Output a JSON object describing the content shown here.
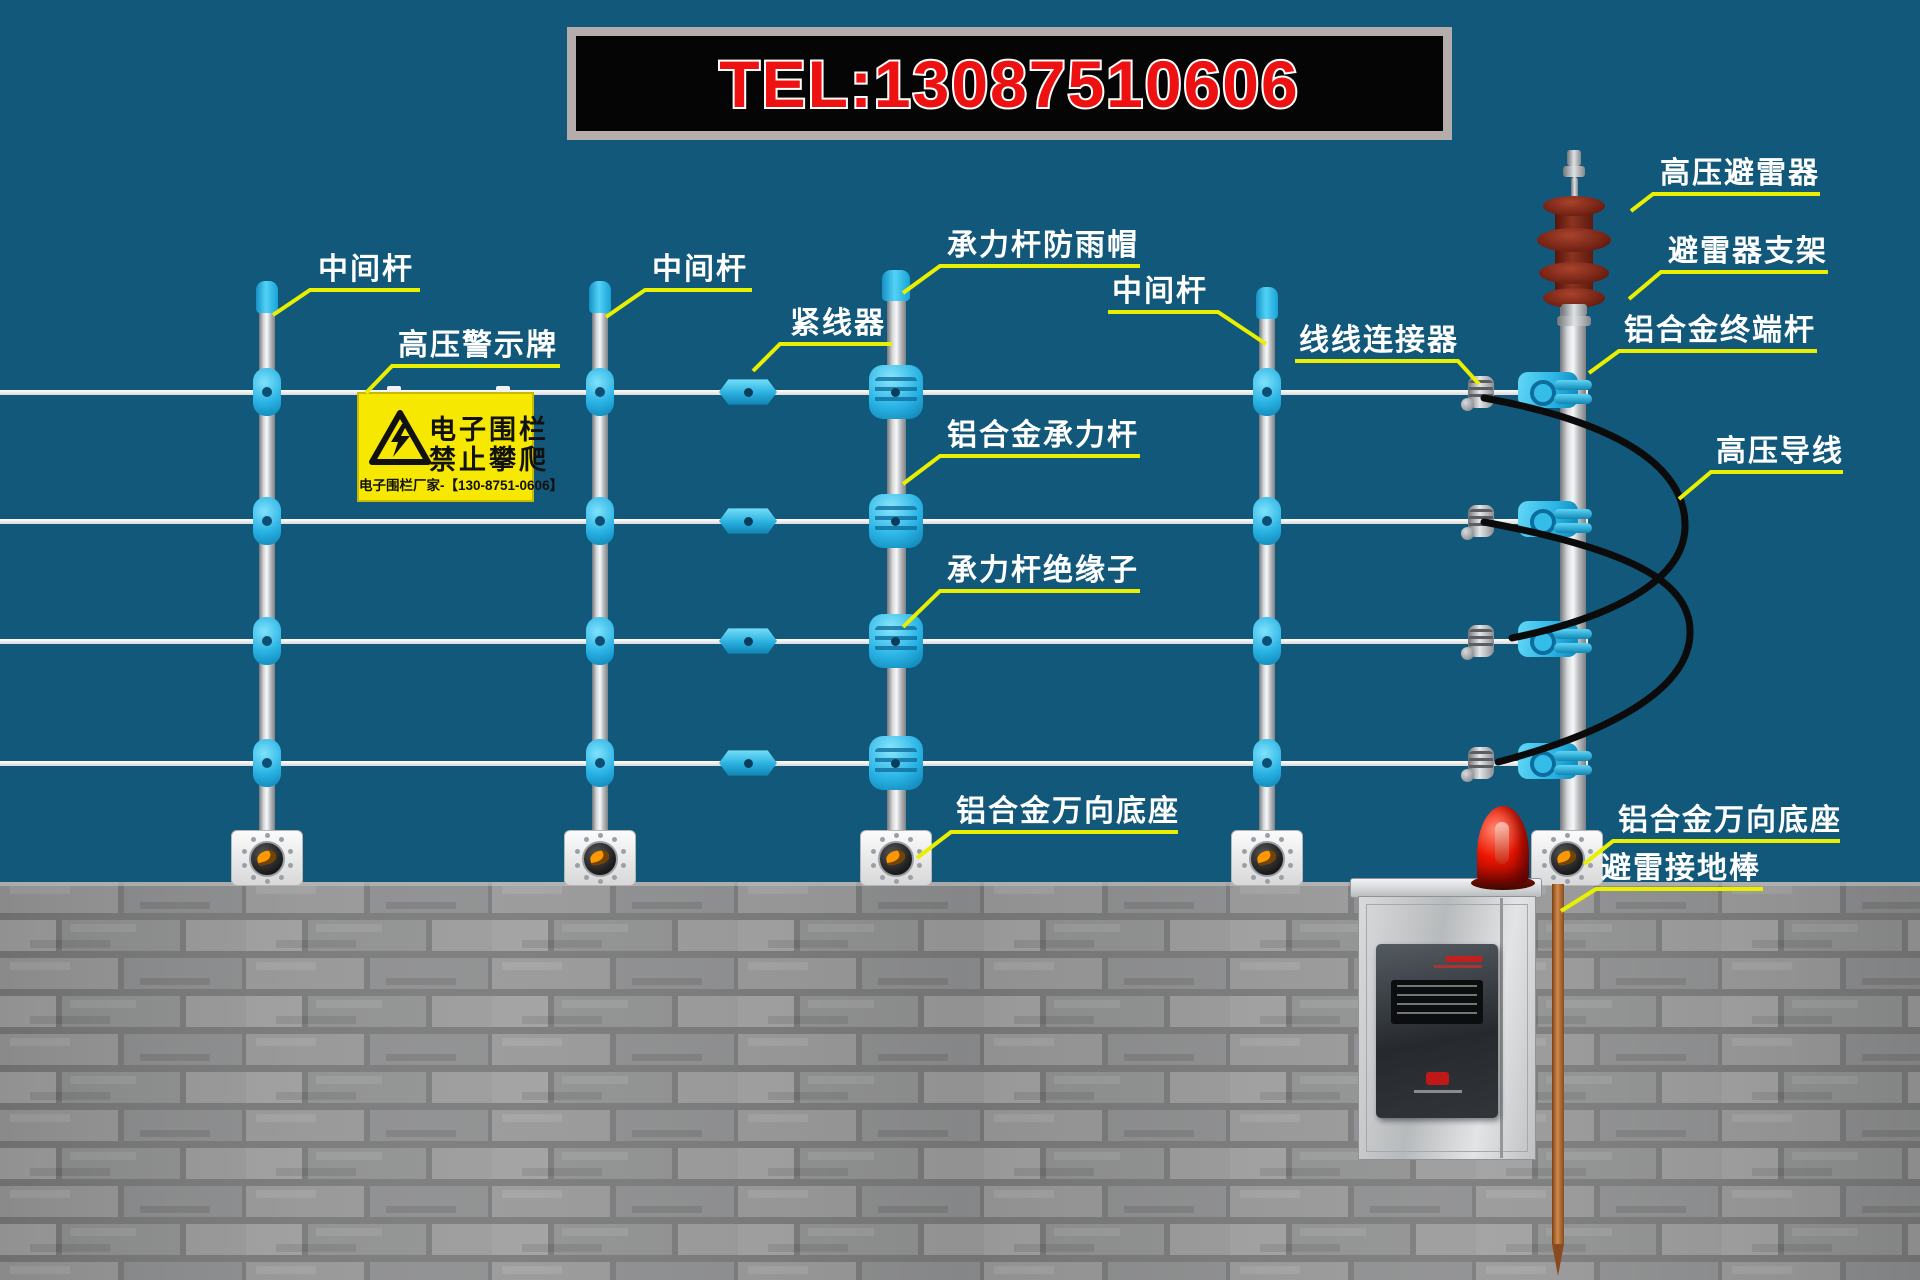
{
  "banner": {
    "tel": "TEL:13087510606"
  },
  "sign": {
    "line1": "电子围栏",
    "line2": "禁止攀爬",
    "footer": "电子围栏厂家-【130-8751-0606】"
  },
  "labels": [
    {
      "id": "mid-pole-1",
      "text": "中间杆"
    },
    {
      "id": "mid-pole-2",
      "text": "中间杆"
    },
    {
      "id": "wire-tensioner",
      "text": "紧线器"
    },
    {
      "id": "bearing-pole-rain-cap",
      "text": "承力杆防雨帽"
    },
    {
      "id": "mid-pole-3",
      "text": "中间杆"
    },
    {
      "id": "hv-warning-sign",
      "text": "高压警示牌"
    },
    {
      "id": "aluminum-bearing-pole",
      "text": "铝合金承力杆"
    },
    {
      "id": "bearing-pole-insulator",
      "text": "承力杆绝缘子"
    },
    {
      "id": "wire-wire-connector",
      "text": "线线连接器"
    },
    {
      "id": "hv-lightning-arrester",
      "text": "高压避雷器"
    },
    {
      "id": "arrester-bracket",
      "text": "避雷器支架"
    },
    {
      "id": "aluminum-terminal-pole",
      "text": "铝合金终端杆"
    },
    {
      "id": "hv-lead-wire",
      "text": "高压导线"
    },
    {
      "id": "aluminum-universal-base-mid",
      "text": "铝合金万向底座"
    },
    {
      "id": "aluminum-universal-base-end",
      "text": "铝合金万向底座"
    },
    {
      "id": "lightning-ground-rod",
      "text": "避雷接地棒"
    }
  ],
  "colors": {
    "background": "#11587a",
    "leader_yellow": "#e8f000",
    "insulator_cyan": "#2bb7e6",
    "sign_yellow": "#f6e800",
    "banner_text_red": "#ee1111",
    "alarm_red": "#e01000",
    "copper_rod": "#b06a32"
  }
}
